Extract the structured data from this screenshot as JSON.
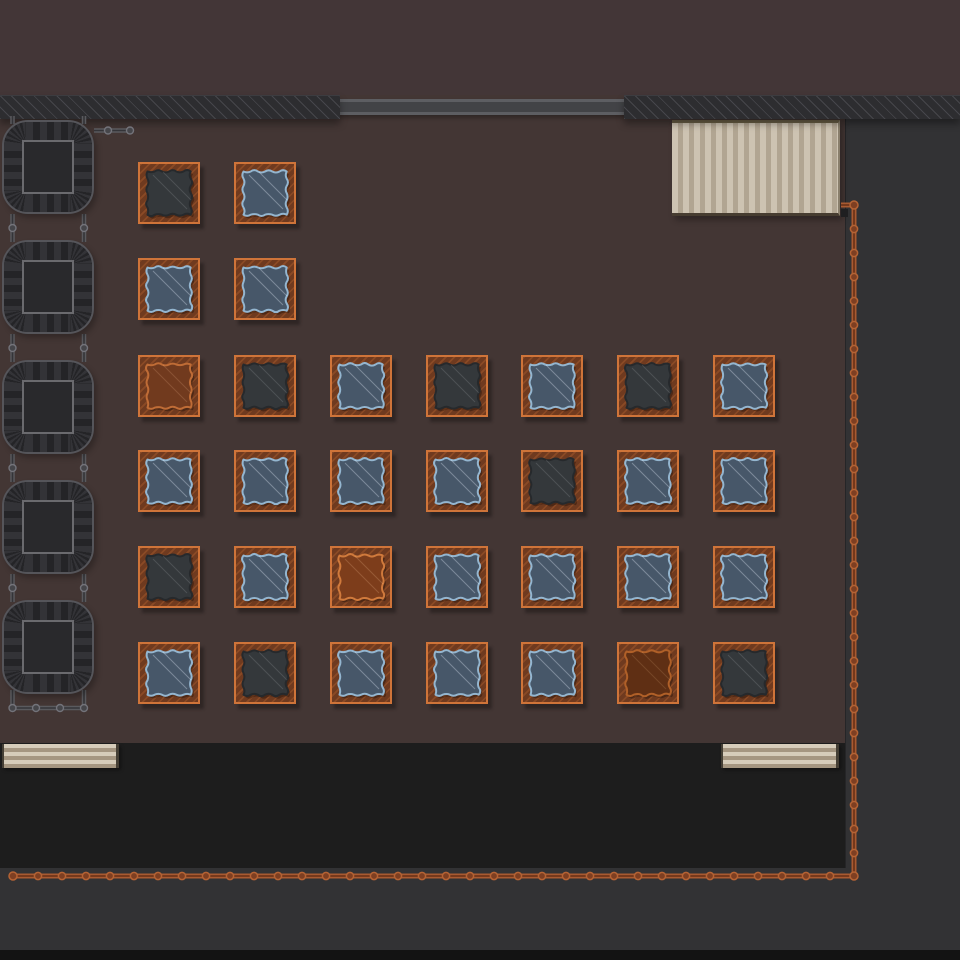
{
  "scene": {
    "type": "top-down-game-scene",
    "elements": [
      "walls",
      "window-bar",
      "awning",
      "machines",
      "pipes",
      "power-conduit",
      "crate-grid",
      "benches",
      "service-areas"
    ]
  },
  "colors": {
    "floor": "#433634",
    "top_band": "#433637",
    "wall": "#2d2d30",
    "wall_hatch": "#46464b",
    "window_bar_mid": "#424346",
    "window_bar_edge": "#5d5e62",
    "side_area": "#323234",
    "black_room": "#1d1d1d",
    "bottom_edge": "#131313",
    "awning_light": "#cdc3b2",
    "awning_dark": "#b1a592",
    "bench_light": "#d6ccba",
    "bench_dark": "#a59681",
    "crate_frame": "#6f3a1f",
    "crate_border": "#cf7439",
    "machine_body": "#242427",
    "machine_stripe": "#333337",
    "machine_border": "#55555a",
    "machine_core_border": "#6a6a6e",
    "pipe_gray": "#5a5a5e",
    "pipe_gray_dark": "#343438",
    "conduit": "#a85a31",
    "conduit_dark": "#6f3519"
  },
  "layout": {
    "top_band": {
      "x": 0,
      "y": 0,
      "w": 960,
      "h": 95
    },
    "wall_left": {
      "x": 0,
      "y": 95,
      "w": 340,
      "h": 23
    },
    "wall_right": {
      "x": 624,
      "y": 95,
      "w": 336,
      "h": 23
    },
    "window_bar": {
      "x": 338,
      "y": 99,
      "w": 288,
      "h": 16
    },
    "side_gray": {
      "x": 845,
      "y": 118,
      "w": 115,
      "h": 832
    },
    "black_room": {
      "x": 0,
      "y": 743,
      "w": 845,
      "h": 125
    },
    "bottom_gray": {
      "x": 0,
      "y": 868,
      "w": 960,
      "h": 82
    },
    "bottom_edge": {
      "x": 0,
      "y": 950,
      "w": 960,
      "h": 10
    },
    "awning": {
      "x": 672,
      "y": 120,
      "w": 168,
      "h": 96
    },
    "awning_post": {
      "x": 841,
      "y": 209,
      "w": 7,
      "h": 8
    },
    "bench_left": {
      "x": 2,
      "y": 744,
      "w": 117,
      "h": 24
    },
    "bench_right": {
      "x": 721,
      "y": 744,
      "w": 118,
      "h": 24
    }
  },
  "machines": {
    "count": 5,
    "x": 2,
    "w": 92,
    "h": 94,
    "ys": [
      120,
      240,
      360,
      480,
      600
    ]
  },
  "machine_pipes": {
    "segments": [
      [
        12.5,
        116,
        12.5,
        124
      ],
      [
        84,
        116,
        84,
        124
      ],
      [
        12.5,
        214,
        12.5,
        242
      ],
      [
        84,
        214,
        84,
        242
      ],
      [
        12.5,
        334,
        12.5,
        362
      ],
      [
        84,
        334,
        84,
        362
      ],
      [
        12.5,
        454,
        12.5,
        482
      ],
      [
        84,
        454,
        84,
        482
      ],
      [
        12.5,
        574,
        12.5,
        602
      ],
      [
        84,
        574,
        84,
        602
      ],
      [
        12.5,
        690,
        12.5,
        708
      ],
      [
        84,
        690,
        84,
        708
      ],
      [
        10.5,
        708,
        86,
        708
      ],
      [
        94,
        130.5,
        130,
        130.5
      ]
    ],
    "nodes": [
      [
        12.5,
        228
      ],
      [
        84,
        228
      ],
      [
        12.5,
        348
      ],
      [
        84,
        348
      ],
      [
        12.5,
        468
      ],
      [
        84,
        468
      ],
      [
        12.5,
        588
      ],
      [
        84,
        588
      ],
      [
        12.5,
        708
      ],
      [
        36,
        708
      ],
      [
        60,
        708
      ],
      [
        84,
        708
      ],
      [
        108,
        130.5
      ],
      [
        130,
        130.5
      ]
    ]
  },
  "conduit": {
    "points": [
      [
        841,
        205
      ],
      [
        854,
        205
      ],
      [
        854,
        876
      ],
      [
        13,
        876
      ]
    ],
    "node_spacing": 24
  },
  "crates": {
    "size": 62,
    "cols_x": [
      138,
      234,
      330,
      426,
      521,
      617,
      713
    ],
    "rows": [
      {
        "y": 162,
        "variants": [
          "dark",
          "blue"
        ]
      },
      {
        "y": 258,
        "variants": [
          "blue",
          "blue"
        ]
      },
      {
        "y": 355,
        "variants": [
          "leather",
          "dark",
          "blue",
          "dark",
          "blue",
          "dark",
          "blue"
        ]
      },
      {
        "y": 450,
        "variants": [
          "blue",
          "blue",
          "blue",
          "blue",
          "dark",
          "blue",
          "blue"
        ]
      },
      {
        "y": 546,
        "variants": [
          "dark",
          "blue",
          "leather_bright",
          "blue",
          "blue",
          "blue",
          "blue"
        ]
      },
      {
        "y": 642,
        "variants": [
          "blue",
          "dark",
          "blue",
          "blue",
          "blue",
          "leather_dark",
          "dark"
        ]
      }
    ],
    "variant_styles": {
      "blue": {
        "fill": "#475769",
        "edge": "#94b6d0",
        "line": "rgba(225,235,245,0.35)"
      },
      "dark": {
        "fill": "#34383b",
        "edge": "#26292c",
        "line": "rgba(220,225,230,0.15)"
      },
      "leather": {
        "fill": "#713a1e",
        "edge": "#bf6c36",
        "line": "rgba(255,200,150,0.18)"
      },
      "leather_bright": {
        "fill": "#7d3d1b",
        "edge": "#d07a3c",
        "line": "rgba(255,210,160,0.20)"
      },
      "leather_dark": {
        "fill": "#5f2f14",
        "edge": "#b06028",
        "line": "rgba(255,200,150,0.15)"
      }
    }
  }
}
